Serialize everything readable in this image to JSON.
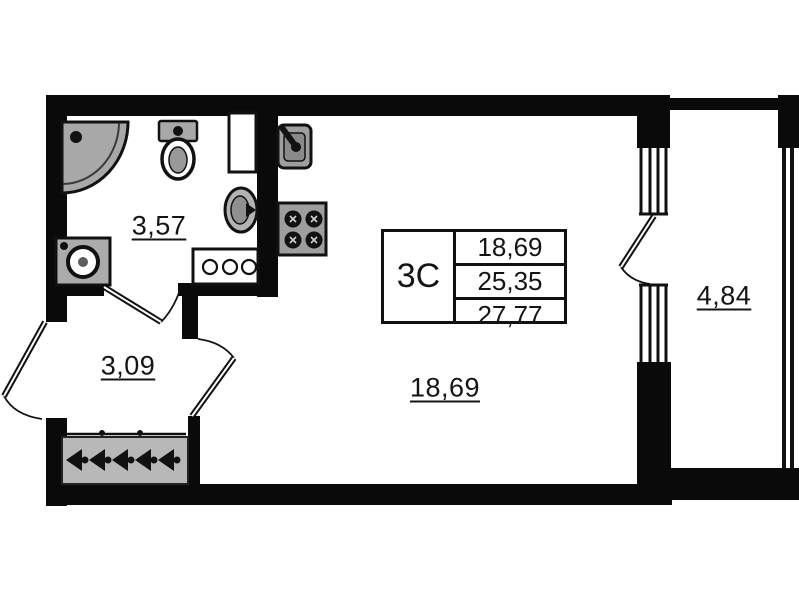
{
  "unit_table": {
    "type": "3C",
    "rows": [
      "18,69",
      "25,35",
      "27,77"
    ]
  },
  "rooms": {
    "bathroom": {
      "area_label": "3,57"
    },
    "hall": {
      "area_label": "3,09"
    },
    "living": {
      "area_label": "18,69"
    },
    "balcony": {
      "area_label": "4,84"
    }
  },
  "icons": [
    "shower-icon",
    "toilet-icon",
    "vent-duct",
    "bathroom-sink-icon",
    "washing-machine-icon",
    "kitchen-sink-icon",
    "stove-icon",
    "counter-knobs",
    "wardrobe-hangers-icon",
    "door-swing-arc",
    "window-glazing"
  ],
  "colors": {
    "wall": "#0a0a0a",
    "fixture_gray": "#a8a8a8",
    "background": "#ffffff"
  }
}
